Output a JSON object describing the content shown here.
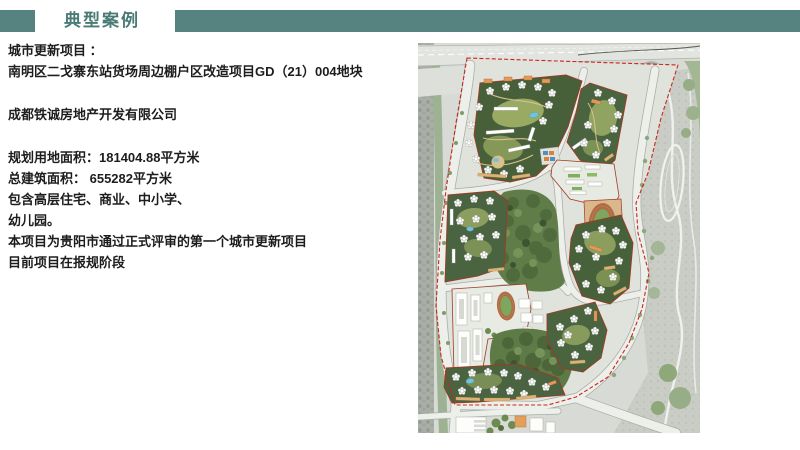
{
  "header": {
    "title": "典型案例",
    "accent_color": "#568380",
    "title_color": "#4a7b77"
  },
  "project": {
    "label": "城市更新项目 ：",
    "name": "南明区二戈寨东站货场周边棚户区改造项目GD（21）004地块",
    "developer": "成都铁诚房地产开发有限公司",
    "land_area": "规划用地面积：181404.88平方米",
    "floor_area": "总建筑面积： 655282平方米",
    "contains_line1": "包含高层住宅、商业、中小学、",
    "contains_line2": "幼儿园。",
    "status_line1": "本项目为贵阳市通过正式评审的第一个城市更新项目",
    "status_line2": "目前项目在报规阶段"
  },
  "map": {
    "boundary_color": "#c9271b",
    "parcel_outline_color": "#9e3a24",
    "park_green": "#5f7c49",
    "road_color": "#edefeb",
    "terrain_gray": "#c9cdc6",
    "water_blue": "#6fc4de",
    "building_white": "#fdfdfc",
    "accent_orange": "#e2995a"
  }
}
